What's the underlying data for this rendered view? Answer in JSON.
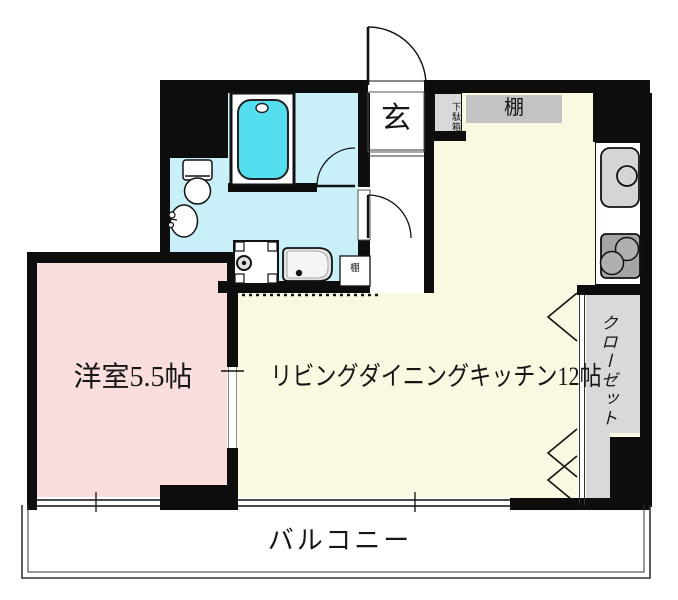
{
  "rooms": {
    "entrance": "玄",
    "shoe_cabinet": "下駄箱",
    "shelf": "棚",
    "small_shelf": "棚",
    "western_room": "洋室5.5帖",
    "ldk": "リビングダイニングキッチン12帖",
    "closet": "クローゼット",
    "balcony": "バルコニー"
  },
  "fixtures": [
    "bathtub-icon",
    "toilet-icon",
    "washbasin-icon",
    "washing-machine-icon",
    "vanity-sink-icon",
    "kitchen-sink-icon",
    "gas-stove-icon",
    "entrance-door-swing-icon",
    "bathroom-door-swing-icon",
    "washroom-door-swing-icon",
    "folding-closet-door-chevrons",
    "window-symbol",
    "sliding-partition-opening"
  ],
  "colors": {
    "wall": "#0d0d0d",
    "western_room_floor": "#fadddd",
    "ldk_floor": "#faf8e1",
    "wet_area_floor": "#c9f0f8",
    "bathtub": "#55dfee",
    "shelf_gray": "#c3c3c3",
    "unit_gray": "#d9d9d9",
    "sink_gray": "#d5d5d5",
    "stove_gray": "#a5a5a5"
  }
}
